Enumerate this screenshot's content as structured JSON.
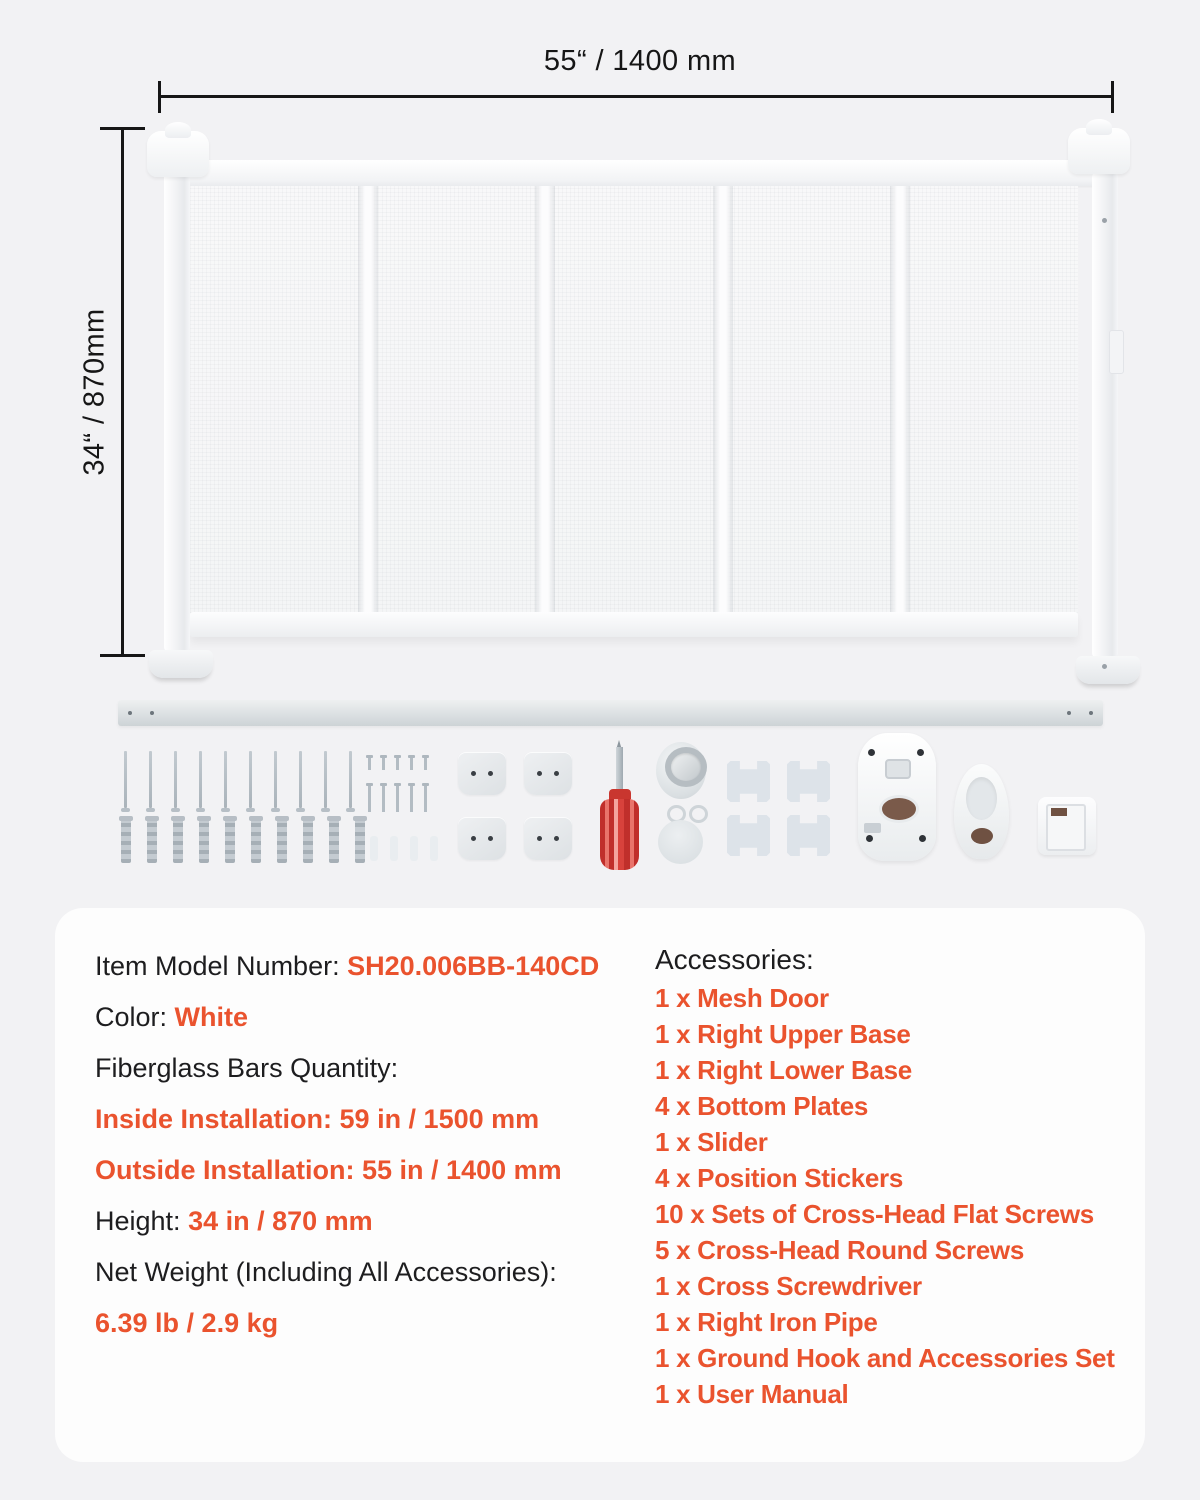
{
  "page": {
    "background": "#f2f2f4",
    "card_background": "#fdfdfd",
    "accent_color": "#ea532e",
    "text_color": "#1d1d1f"
  },
  "dimensions": {
    "width_label": "55“ / 1400 mm",
    "height_label": "34“ / 870mm"
  },
  "hardware_counts": {
    "flat_screws": 10,
    "wall_anchors": 10,
    "round_screws_top": 5,
    "round_screws_bottom": 5,
    "plastic_plugs": 4,
    "bottom_plates": 4,
    "position_stickers": 4
  },
  "specs": [
    {
      "label": "Item Model Number: ",
      "value": "SH20.006BB-140CD"
    },
    {
      "label": "Color: ",
      "value": "White"
    },
    {
      "label": "Fiberglass Bars Quantity:",
      "value": ""
    },
    {
      "label": "",
      "value": "Inside Installation: 59 in / 1500 mm"
    },
    {
      "label": "",
      "value": "Outside Installation: 55 in / 1400 mm"
    },
    {
      "label": "Height: ",
      "value": "34 in / 870 mm"
    },
    {
      "label": "Net Weight (Including All Accessories):",
      "value": ""
    },
    {
      "label": "",
      "value": "6.39 lb / 2.9 kg"
    }
  ],
  "accessories": {
    "title": "Accessories:",
    "items": [
      "1 x Mesh Door",
      "1 x Right Upper Base",
      "1 x Right Lower Base",
      "4 x Bottom Plates",
      "1 x Slider",
      "4 x Position Stickers",
      "10 x Sets of Cross-Head Flat Screws",
      "5 x Cross-Head Round Screws",
      "1 x Cross Screwdriver",
      "1 x Right Iron Pipe",
      "1 x Ground Hook and Accessories Set",
      "1 x User Manual"
    ]
  }
}
